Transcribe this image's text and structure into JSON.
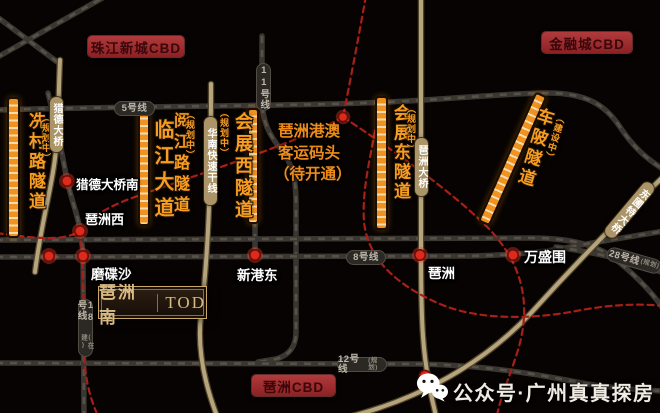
{
  "badges": {
    "top_left": "珠江新城CBD",
    "top_right": "金融城CBD",
    "bottom": "琶洲CBD"
  },
  "logo": {
    "cn": "琶洲南",
    "en": "TOD"
  },
  "port": {
    "line1": "琶洲港澳",
    "line2": "客运码头",
    "line3": "（待开通）"
  },
  "tunnels": {
    "xiancun": {
      "name": "冼村路隧道",
      "status": "（规划中）"
    },
    "linjiang": {
      "name": "临江大道"
    },
    "yuejiang": {
      "name": "阅江路隧道",
      "status": "（规划中）"
    },
    "huizhanxi": {
      "name": "会展西隧道",
      "status": "（规划中）"
    },
    "huizhandong": {
      "name": "会展东隧道",
      "status": "（规划中）"
    },
    "chebei": {
      "name": "车陂隧道",
      "status": "（建设中）"
    }
  },
  "roads": {
    "liede": "猎德大桥",
    "huanan": "华南快速干线",
    "pazhou_bridge": "琶洲大桥",
    "dongpu": "东圃特大桥"
  },
  "metro": {
    "line5": "5号线",
    "line11": "11号线",
    "line8": "8号线",
    "line12": "12号线",
    "line12_status": "(规划)",
    "line28": "28号线",
    "line28_status": "(规划)",
    "line18": "18号线",
    "line18_status": "(在建)"
  },
  "stations": {
    "liede_south": "猎德大桥南",
    "pazhou_west": "琶洲西",
    "modiesha": "磨碟沙",
    "xingang_east": "新港东",
    "pazhou": "琶洲",
    "wanshengwei": "万盛围"
  },
  "footer": {
    "account": "公众号·广州真真探房"
  },
  "colors": {
    "accent_orange": "#f09422",
    "road_tan": "#b5a47c",
    "metro_dark": "#3a3631",
    "dashed_red": "#a81f17",
    "badge_red": "#a33034",
    "station_red": "#dc2b1d",
    "gold": "#d8ba84"
  }
}
